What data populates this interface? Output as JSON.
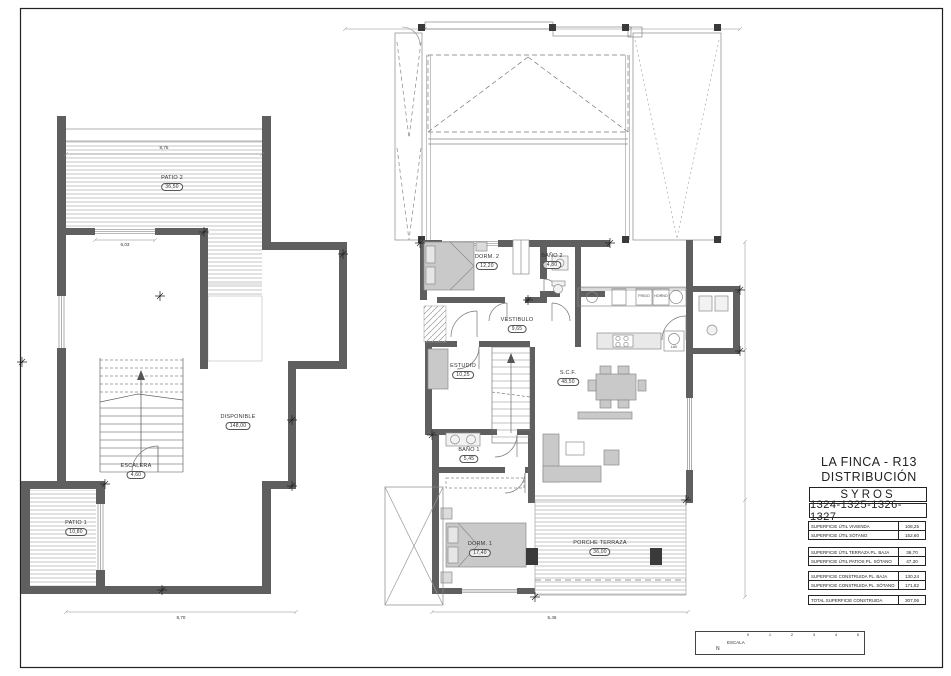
{
  "sheet": {
    "background": "#ffffff",
    "line_color": "#333333",
    "wall_color": "#5f5f5f"
  },
  "title_block": {
    "project": "LA FINCA - R13",
    "drawing_title": "DISTRIBUCIÓN",
    "model": "SYROS",
    "plots": "1324-1325-1326-1327",
    "table": {
      "rows": [
        {
          "label": "SUPERFICIE ÚTIL VIVIENDA",
          "value": "108,25"
        },
        {
          "label": "SUPERFICIE ÚTIL SÓTANO",
          "value": "152,60"
        },
        {
          "label": "SUPERFICIE ÚTIL TERRAZA PL. BAJA",
          "value": "36,70"
        },
        {
          "label": "SUPERFICIE ÚTIL PATIOS PL. SÓTANO",
          "value": "47,30"
        },
        {
          "label": "SUPERFICIE CONSTRUIDA PL. BAJA",
          "value": "130,24"
        },
        {
          "label": "SUPERFICIE CONSTRUIDA PL. SÓTANO",
          "value": "171,82"
        },
        {
          "label": "TOTAL SUPERFICIE CONSTRUIDA",
          "value": "307,06"
        }
      ]
    }
  },
  "rooms": {
    "patio2": {
      "name": "PATIO 2",
      "area": "36,50"
    },
    "disponible": {
      "name": "DISPONIBLE",
      "area": "148,00"
    },
    "escalera": {
      "name": "ESCALERA",
      "area": "4,60"
    },
    "patio1": {
      "name": "PATIO 1",
      "area": "10,80"
    },
    "dorm2": {
      "name": "DORM. 2",
      "area": "12,20"
    },
    "bano2": {
      "name": "BAÑO 2",
      "area": "4,80"
    },
    "vestibulo": {
      "name": "VESTIBULO",
      "area": "9,65"
    },
    "estudio": {
      "name": "ESTUDIO",
      "area": "10,25"
    },
    "salon": {
      "name": "S.C.F.",
      "area": "48,50"
    },
    "bano1": {
      "name": "BAÑO 1",
      "area": "5,45"
    },
    "dorm1": {
      "name": "DORM. 1",
      "area": "17,40"
    },
    "porche": {
      "name": "PORCHE TERRAZA",
      "area": "36,00"
    }
  },
  "dimensions": {
    "patio2_width": "8,75",
    "sotano_opening": "6,03",
    "sotano_total": "8,70",
    "baja_total": "5,45"
  },
  "kitchen": {
    "fridge": "FRIGO",
    "oven": "HORNO",
    "laundry": "LAV"
  },
  "scale_box": {
    "north": "N",
    "label": "ESCALA",
    "ticks": [
      "0",
      "1",
      "2",
      "3",
      "4",
      "5"
    ]
  }
}
